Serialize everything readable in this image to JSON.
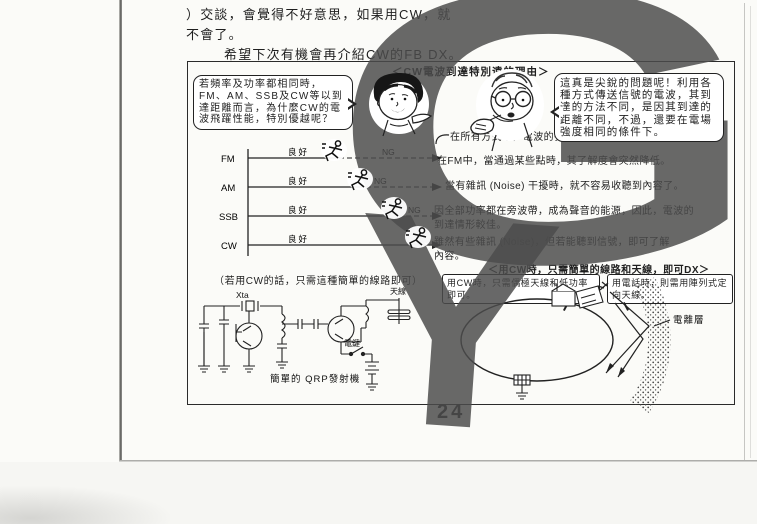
{
  "intro": {
    "line1": "）交談，會覺得不好意思，如果用CW，就",
    "line2": "不會了。",
    "line3": "希望下次有機會再介紹CW的FB DX。"
  },
  "page_number": "24",
  "watermark": {
    "letter_top": "G",
    "letter_bottom": "Y",
    "color": "#4c4c4c"
  },
  "panel": {
    "title": "＜CW電波到達特別遠的理由＞",
    "question_bubble": "若頻率及功率都相同時，FM、AM、SSB及CW等以到達距離而言，為什麼CW的電波飛躍性能，特別優越呢？",
    "answer_bubble": "這真是尖銳的問題呢！利用各種方式傳送信號的電波，其到達的方法不同，是因其到達的距離不同，不過，還要在電場強度相同的條件下。",
    "chart": {
      "type": "distance-comparison",
      "rows": [
        {
          "mode": "FM",
          "good_label": "良好",
          "ng_label": "NG",
          "good_fraction": 0.47
        },
        {
          "mode": "AM",
          "good_label": "良好",
          "ng_label": "NG",
          "good_fraction": 0.62
        },
        {
          "mode": "SSB",
          "good_label": "良好",
          "ng_label": "NG",
          "good_fraction": 0.72
        },
        {
          "mode": "CW",
          "good_label": "良好",
          "ng_label": "",
          "good_fraction": 1.0
        }
      ]
    },
    "notes": {
      "all": "在所有方式中，電波的強度相同。",
      "fm": "在FM中，當通過某些點時，其了解度會突然降低。",
      "am": "當有雜訊 (Noise) 干擾時，就不容易收聽到內容了。",
      "ssb_1": "因全部功率都在旁波帶，成為聲音的能源，因此，電波的",
      "ssb_2": "到達情形較佳。",
      "cw_1": "雖然有些雜訊 (Noise)，但若能聽到信號，即可了解",
      "cw_2": "內容。"
    },
    "circuit_section": {
      "caption": "（若用CW的話，只需這種簡單的線路即可）",
      "xtal_label": "Xta",
      "key_label": "電鍵",
      "antenna_label": "天線",
      "name": "簡單的 QRP發射機"
    },
    "dx_section": {
      "header": "＜用CW時，只需簡單的線路和天線，即可DX＞",
      "cw_box": "用CW時，只需偶極天線和低功率即可。",
      "phone_box": "用電話時，則需用陣列式定向天線。",
      "ionosphere_label": "電離層"
    }
  }
}
